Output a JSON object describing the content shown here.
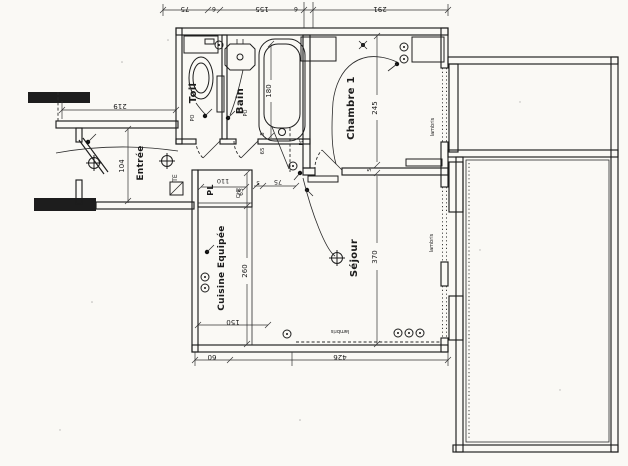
{
  "plan": {
    "kind": "scanned apartment floor plan, drawing rotated 90°"
  },
  "colors": {
    "paper": "#faf9f5",
    "ink": "#1d1d1d"
  },
  "rooms": {
    "toil": "Toil",
    "bain": "Bain",
    "entree": "Entrée",
    "chambre": "Chambre 1",
    "sejour": "Séjour",
    "cuisine": "Cuisine Equipée",
    "placard": "PL"
  },
  "dims": {
    "top_chain": [
      "75",
      "6",
      "155",
      "6",
      "291"
    ],
    "left_width": "219",
    "entree_width": "104",
    "bath_length": "180",
    "wall5": "5",
    "hall_gap": "65",
    "door_width": "75",
    "pl_width": "110",
    "pl_depth": "65",
    "cuisine_length": "260",
    "cuisine_width": "150",
    "chambre_length": "245",
    "sejour_length": "370",
    "bottom_chain": [
      "60",
      "426"
    ]
  },
  "ann": {
    "te": "TE",
    "che": "CHE",
    "po": "PO",
    "lambris": "lambris"
  }
}
